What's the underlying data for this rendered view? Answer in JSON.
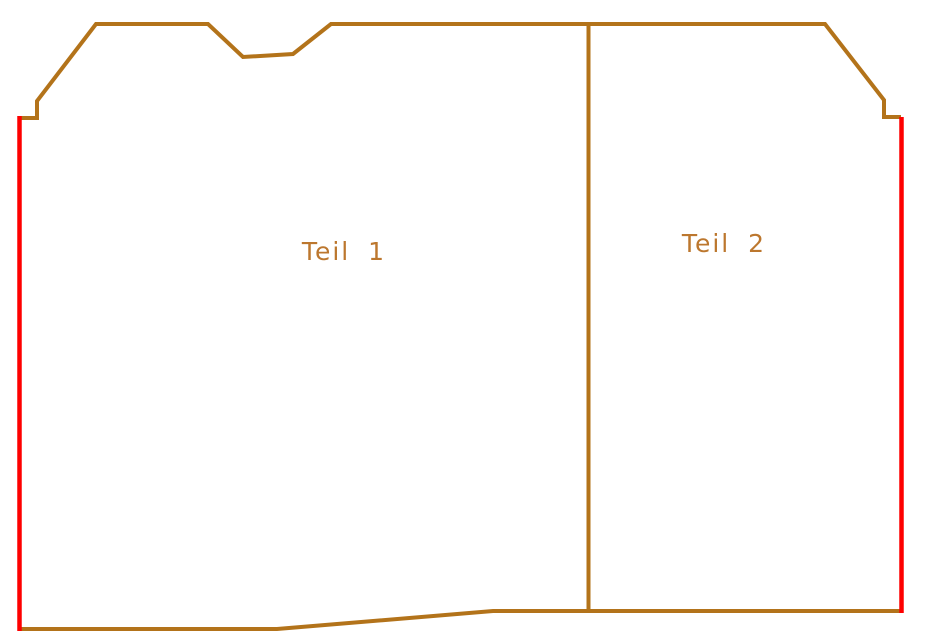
{
  "drawing": {
    "parts": [
      {
        "label": "Teil 1"
      },
      {
        "label": "Teil 2"
      }
    ],
    "colors": {
      "outline": "#b3731a",
      "edge_line": "#fe0000",
      "label": "#bc772e"
    },
    "background": "#ffffff"
  }
}
